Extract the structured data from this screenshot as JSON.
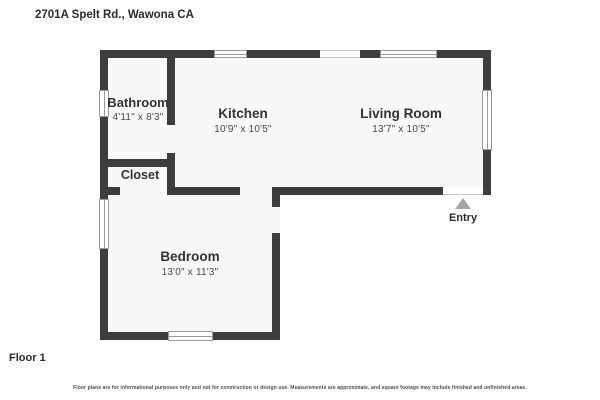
{
  "header": {
    "address": "2701A Spelt Rd., Wawona CA"
  },
  "floor_label": "Floor 1",
  "entry": {
    "label": "Entry",
    "arrow_icon": "triangle-up"
  },
  "rooms": [
    {
      "name": "Bathroom",
      "dimensions": "4'11\" x 8'3\""
    },
    {
      "name": "Kitchen",
      "dimensions": "10'9\" x 10'5\""
    },
    {
      "name": "Living Room",
      "dimensions": "13'7\" x 10'5\""
    },
    {
      "name": "Closet",
      "dimensions": ""
    },
    {
      "name": "Bedroom",
      "dimensions": "13'0\" x 11'3\""
    }
  ],
  "disclaimer": "Floor plans are for informational purposes only and not for construction or design use. Measurements are approximate, and square footage may include finished and unfinished areas.",
  "colors": {
    "wall": "#3d3d3d",
    "room_fill": "#f8f8f8",
    "window_frame": "#9a9a9a",
    "entry_arrow": "#a6a6a6",
    "text": "#333333"
  }
}
